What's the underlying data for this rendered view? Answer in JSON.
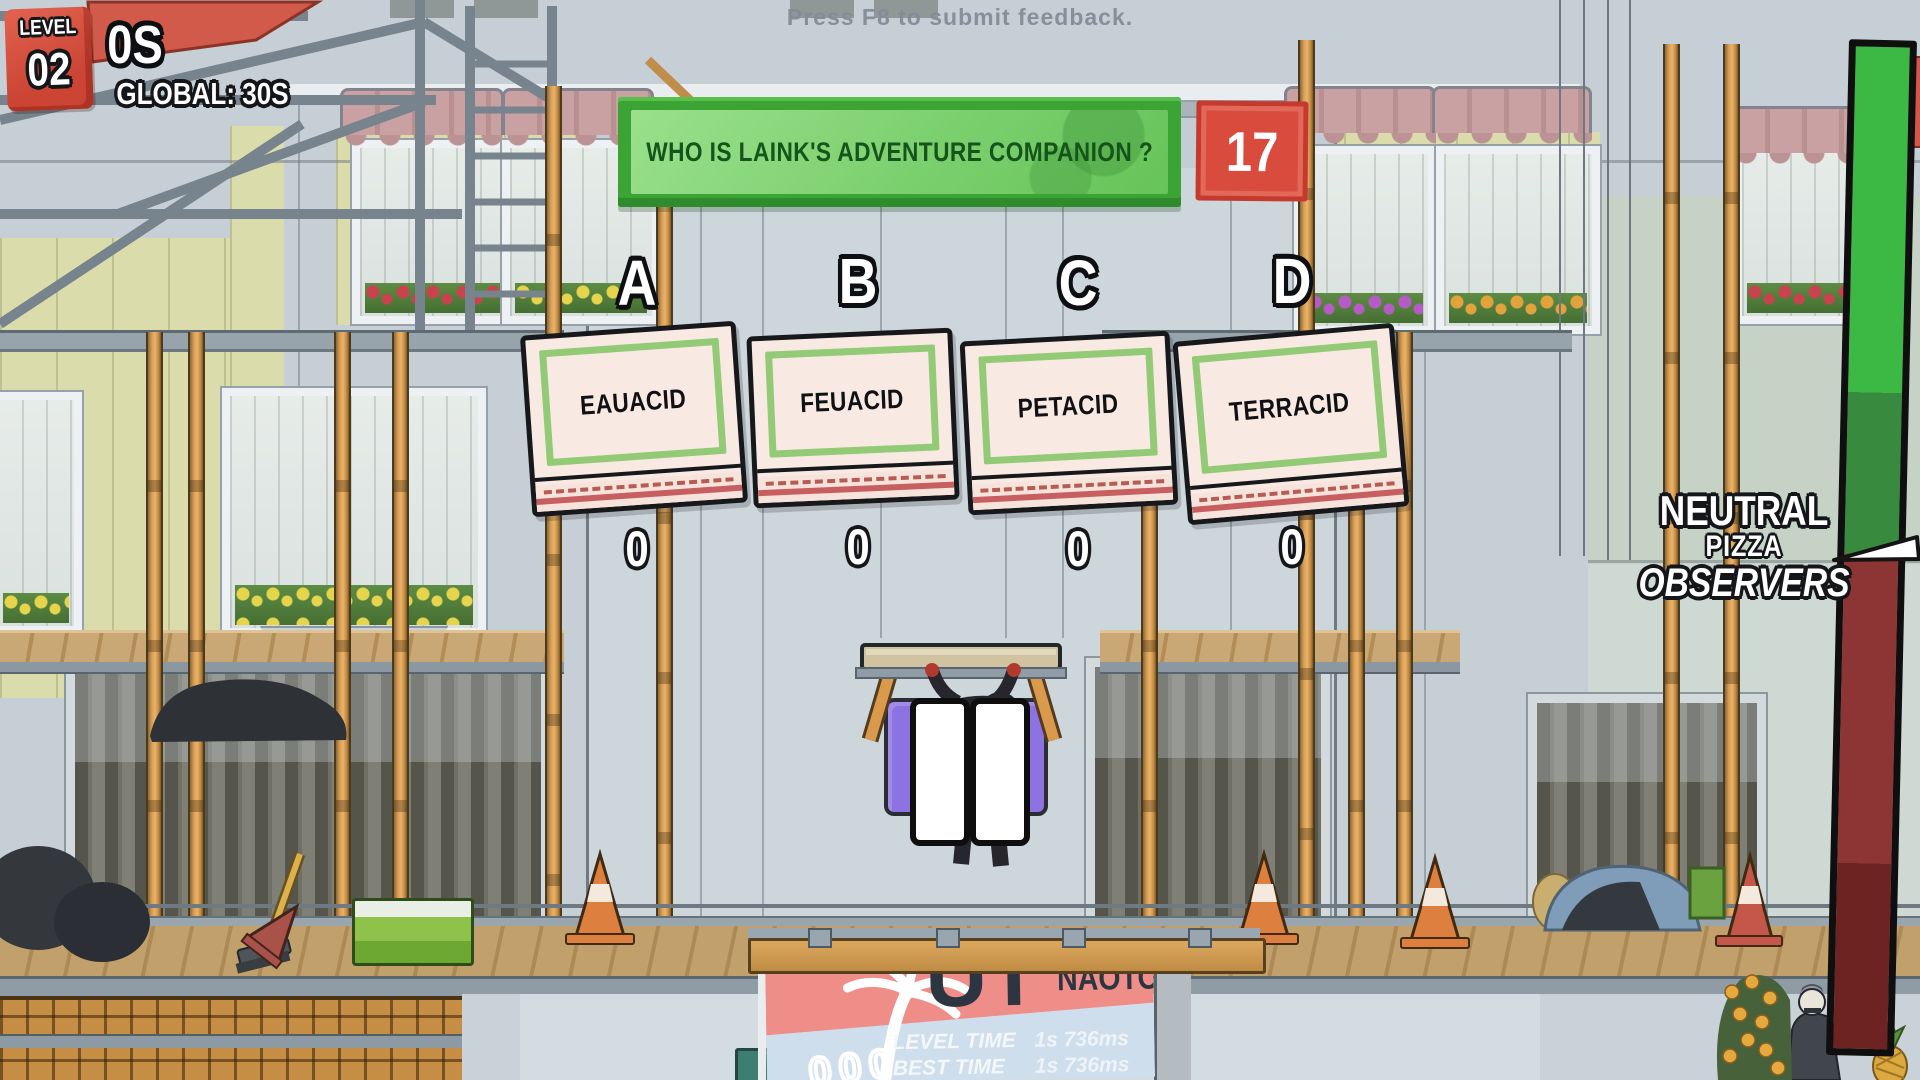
{
  "hud": {
    "feedback_hint": "Press F8 to submit feedback.",
    "level_label": "LEVEL",
    "level_value": "02",
    "round_timer": "0S",
    "global_timer": "GLOBAL: 30S",
    "question": "WHO IS LAINK'S ADVENTURE COMPANION ?",
    "countdown": "17"
  },
  "answers": [
    {
      "letter": "A",
      "label": "EAUACID",
      "count": "0"
    },
    {
      "letter": "B",
      "label": "FEUACID",
      "count": "0"
    },
    {
      "letter": "C",
      "label": "PETACID",
      "count": "0"
    },
    {
      "letter": "D",
      "label": "TERRACID",
      "count": "0"
    }
  ],
  "audience_meter": {
    "line1": "NEUTRAL",
    "line2": "PIZZA",
    "line3": "OBSERVERS"
  },
  "scoreboard": {
    "partial_word": "UT",
    "player_name": "NAOTO",
    "rows": [
      {
        "label": "LEVEL TIME",
        "value": "1s 736ms"
      },
      {
        "label": "BEST TIME",
        "value": "1s 736ms"
      }
    ],
    "digits": "000"
  },
  "colors": {
    "banner_green": "#46b33c",
    "banner_green_light": "#8bd97d",
    "banner_text_green": "#15541a",
    "countdown_red": "#d84b3c",
    "level_badge_red": "#d25243",
    "pizza_box_cream": "#f9e9e3",
    "pizza_box_green_frame": "#92ca76",
    "pause_purple": "#8d72e2",
    "gauge_bright_green": "#3cb844",
    "gauge_dark_green": "#388a3e",
    "gauge_red": "#8d3535",
    "gauge_dark_red": "#6e2323"
  }
}
